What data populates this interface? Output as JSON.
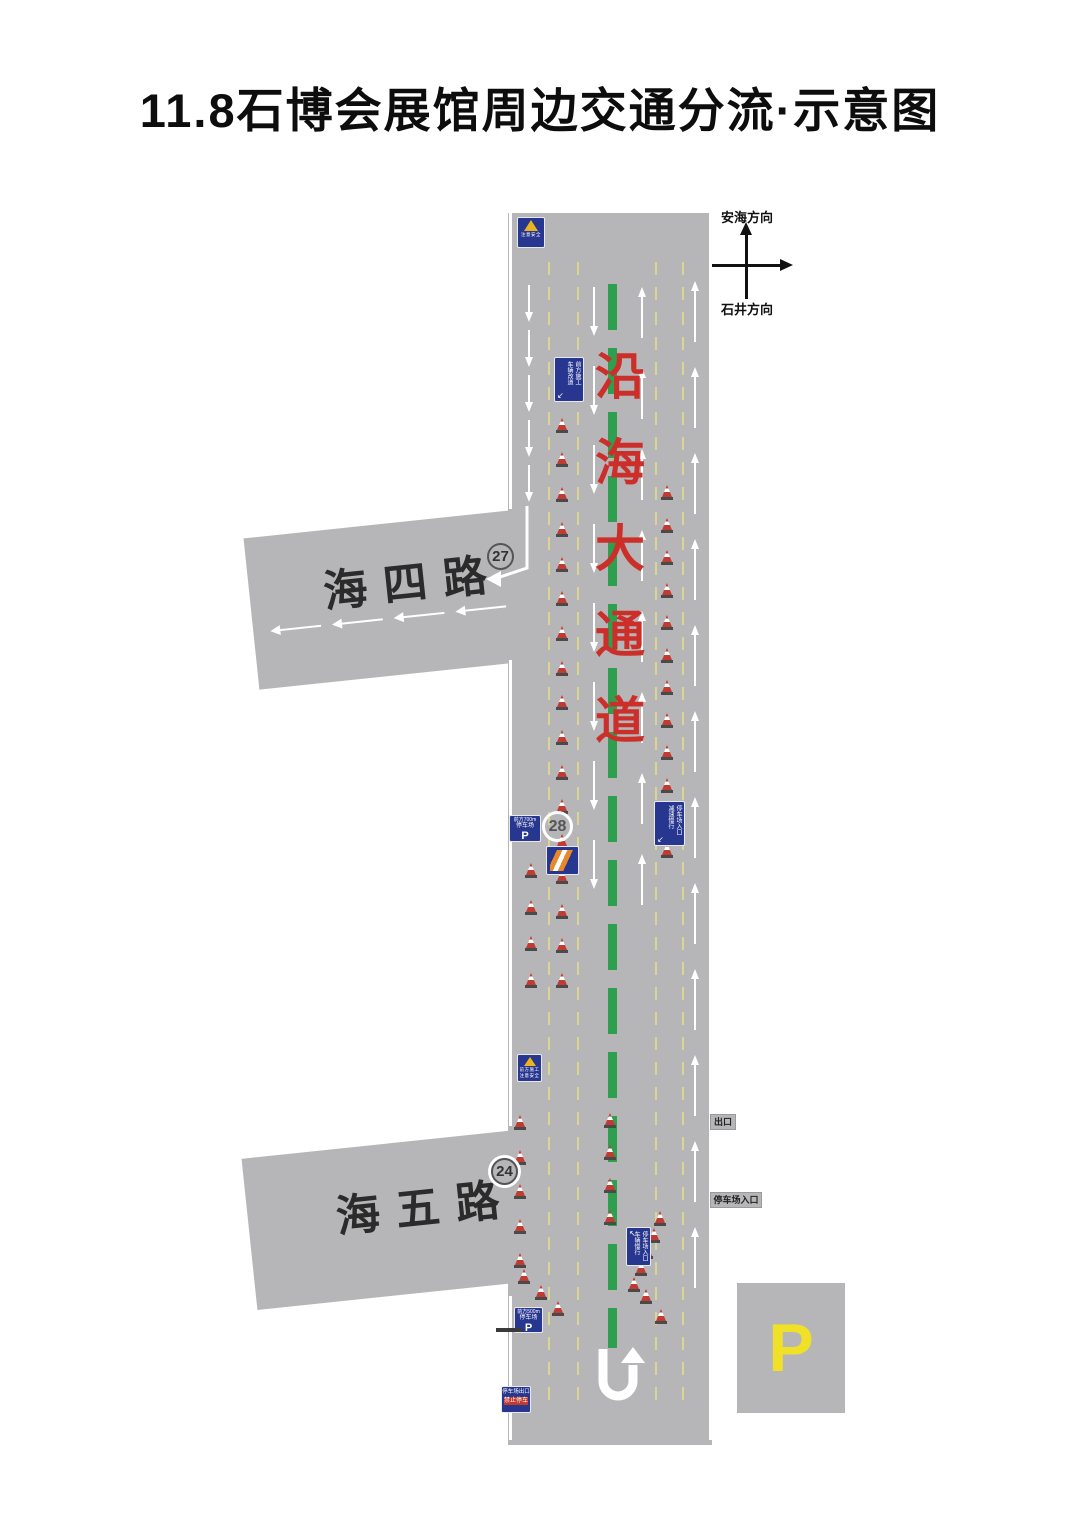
{
  "title": "11.8石博会展馆周边交通分流·示意图",
  "compass": {
    "up": "安海方向",
    "down": "石井方向"
  },
  "main_road": {
    "name": "沿海大通道"
  },
  "side_roads": [
    {
      "name": "海四路",
      "badge": "27"
    },
    {
      "name": "海五路",
      "badge": "24"
    }
  ],
  "badges": {
    "main": "28"
  },
  "labels": {
    "exit_tab": "出口",
    "entrance_tab": "停车场入口",
    "parking_big": "P"
  },
  "signs": {
    "warning_top": {
      "line1": "注意安全"
    },
    "lane_closed_left": {
      "col1": "前方施工",
      "col2": "车辆改道",
      "arrow": "↙"
    },
    "parking_700": {
      "line1": "前方700m",
      "line2": "停车场",
      "p": "P"
    },
    "lane_closed_right": {
      "col1": "停车场入口",
      "col2": "减速慢行",
      "arrow": "↙"
    },
    "warning_mid": {
      "line1": "前方施工",
      "line2": "注意安全"
    },
    "lane_closed_low": {
      "col1": "停车场入口",
      "col2": "车辆慢行",
      "arrow": "↖"
    },
    "parking_500": {
      "line1": "前方500m",
      "line2": "停车场",
      "p": "P"
    },
    "exit_sign": {
      "line1": "停车场出口",
      "line2": "禁止停车"
    }
  },
  "colors": {
    "road": "#b6b6b8",
    "sign_blue": "#27368f",
    "green_center_line": "#2e9e4f",
    "yellow_lane_line": "#dbd592",
    "road_name_red": "#cc2f2a",
    "cone_red": "#c23b33",
    "parking_p_yellow": "#f0e028"
  },
  "diagram": {
    "edge_segments": [
      {
        "x": 509,
        "y1": 213,
        "y2": 509
      },
      {
        "x": 509,
        "y1": 660,
        "y2": 1126
      },
      {
        "x": 509,
        "y1": 1296,
        "y2": 1440
      },
      {
        "x": 709,
        "y1": 213,
        "y2": 1440
      }
    ],
    "yellow_lines": [
      548,
      577,
      655,
      682
    ],
    "yellow_y1": 262,
    "yellow_y2": 1405,
    "green_line": {
      "x": 608,
      "y1": 284,
      "y2": 1348
    },
    "arrow_columns": [
      {
        "x": 528,
        "dir": "down",
        "y": 285,
        "count": 5,
        "gap": 45,
        "len": 28
      },
      {
        "x": 593,
        "dir": "down",
        "y": 287,
        "count": 8,
        "gap": 79,
        "len": 40
      },
      {
        "x": 641,
        "dir": "up",
        "y": 296,
        "count": 8,
        "gap": 81,
        "len": 42
      },
      {
        "x": 694,
        "dir": "up",
        "y": 290,
        "count": 12,
        "gap": 86,
        "len": 52
      }
    ],
    "cone_groups": [
      {
        "x1": 562,
        "y1": 398,
        "x2": 562,
        "y2": 988,
        "n": 18
      },
      {
        "x1": 531,
        "y1": 878,
        "x2": 531,
        "y2": 988,
        "n": 4
      },
      {
        "x1": 667,
        "y1": 500,
        "x2": 667,
        "y2": 858,
        "n": 12
      },
      {
        "x1": 520,
        "y1": 1130,
        "x2": 520,
        "y2": 1268,
        "n": 5
      },
      {
        "x1": 524,
        "y1": 1284,
        "x2": 558,
        "y2": 1316,
        "n": 3
      },
      {
        "x1": 610,
        "y1": 1128,
        "x2": 610,
        "y2": 1225,
        "n": 4
      },
      {
        "x1": 660,
        "y1": 1226,
        "x2": 634,
        "y2": 1292,
        "n": 5
      },
      {
        "x1": 646,
        "y1": 1304,
        "x2": 661,
        "y2": 1324,
        "n": 2
      }
    ],
    "hai4_arrows": {
      "y": 94,
      "len": 42,
      "xs": [
        26,
        88,
        150,
        212
      ]
    }
  }
}
